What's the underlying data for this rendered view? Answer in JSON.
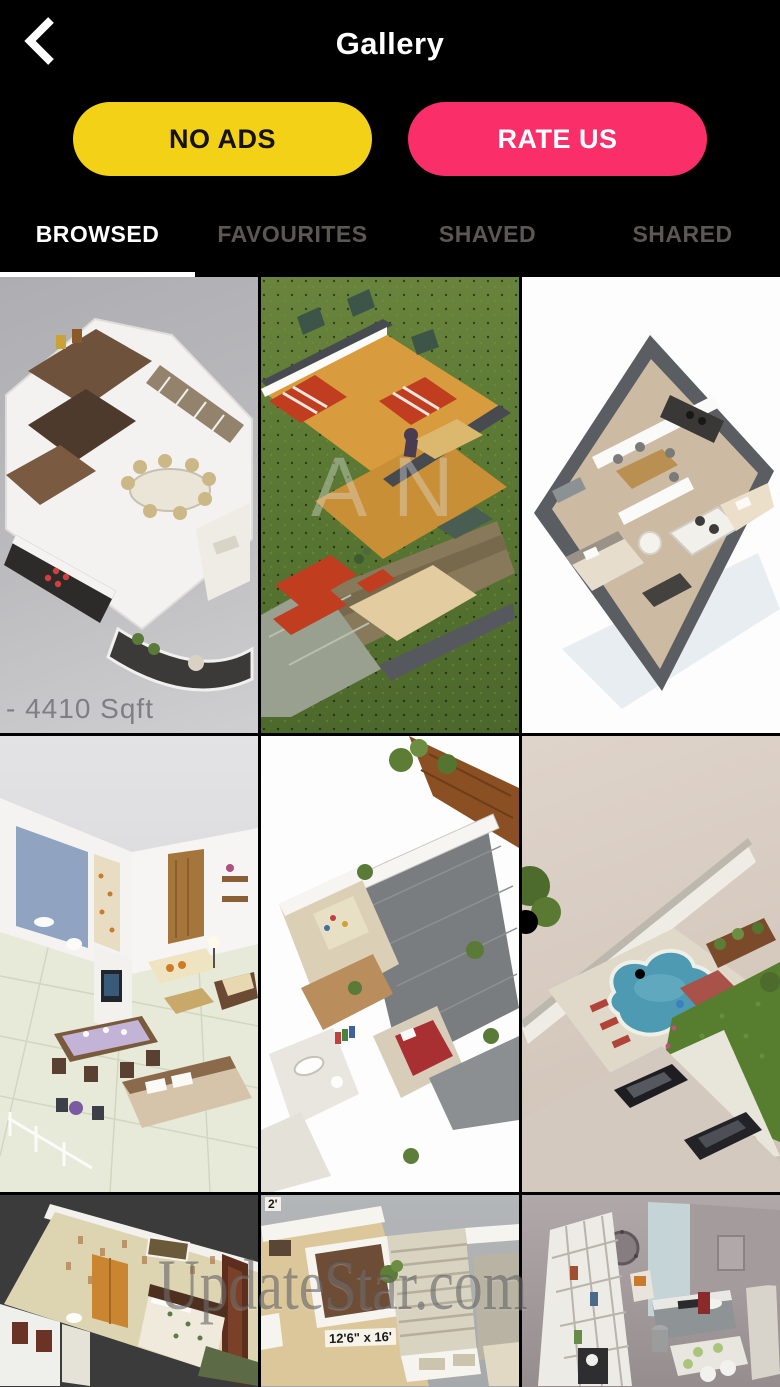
{
  "header": {
    "title": "Gallery",
    "back_icon": "chevron-left"
  },
  "actions": {
    "no_ads": {
      "label": "NO ADS",
      "bg": "#F2D117",
      "text_color": "#161208"
    },
    "rate_us": {
      "label": "RATE US",
      "bg": "#FA2E68",
      "text_color": "#FFFFFF"
    }
  },
  "tabs": [
    {
      "label": "BROWSED",
      "active": true
    },
    {
      "label": "FAVOURITES",
      "active": false
    },
    {
      "label": "SHAVED",
      "active": false
    },
    {
      "label": "SHARED",
      "active": false
    }
  ],
  "colors": {
    "background": "#000000",
    "active_tab_text": "#FFFFFF",
    "inactive_tab_text": "#5C5753",
    "tab_underline": "#FFFFFF"
  },
  "gallery": {
    "watermark": "UpdateStar.com",
    "partial_watermark": "AN",
    "tiles": [
      {
        "description": "3D floor plan render on gray backdrop with wooden rooms, dining table, dark kitchen counter, staircase and curved balcony",
        "caption": "- 4410 Sqft"
      },
      {
        "description": "3D floor plan on green lawn with wooden floors, red striped beds, red sofas and stone base"
      },
      {
        "description": "3D apartment plan on white backdrop with dark gray walls, tan floor, white sofas and two bedrooms"
      },
      {
        "description": "3D room render with blue bathroom wall, wooden door, beige sofas, dining table and bed"
      },
      {
        "description": "Sprawling white-wall 3D floor plan with gray courtyards, plants, red bed and wooden deck"
      },
      {
        "description": "Aerial backyard render with kidney-shaped pool, pergola, lawn and two parked cars"
      },
      {
        "description": "3D bedroom render with patterned cream walls, floral bed, dark wood door frames and green carpet"
      },
      {
        "description": "Top-down floor plan with tan carpet, brown room and staircase",
        "labels": {
          "size": "12'6\" x 16'",
          "corner": "2'"
        }
      },
      {
        "description": "3D kitchen render with mauve walls, white shelving unit, round mirror and gray counters"
      }
    ]
  }
}
